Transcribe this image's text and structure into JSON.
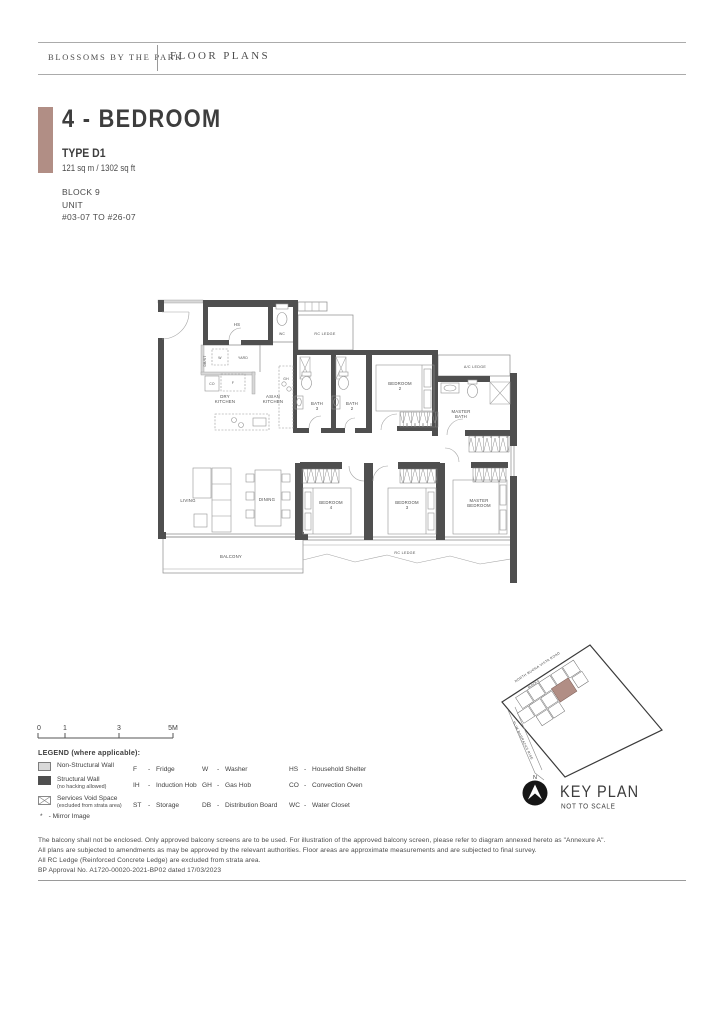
{
  "header": {
    "brand": "BLOSSOMS BY THE PARK",
    "section": "FLOOR PLANS"
  },
  "title_block": {
    "title": "4 - BEDROOM",
    "type": "TYPE D1",
    "area": "121 sq m / 1302 sq ft",
    "block": "BLOCK 9",
    "unit_label": "UNIT",
    "unit_range": "#03-07 TO #26-07"
  },
  "floor_plan": {
    "labels": {
      "hs": "HS",
      "wc": "WC",
      "rc_ledge_top": "RC LEDGE",
      "db_st": "DB/ST",
      "washer": "W",
      "yard": "YARD",
      "co": "CO",
      "fridge": "F",
      "dry_kitchen": [
        "DRY",
        "KITCHEN"
      ],
      "asian_kitchen": [
        "ASIAN",
        "KITCHEN"
      ],
      "gh": "GH",
      "bath3": [
        "BATH",
        "3"
      ],
      "bath2": [
        "BATH",
        "2"
      ],
      "bedroom2": [
        "BEDROOM",
        "2"
      ],
      "ac_ledge": "A/C LEDGE",
      "master_bath": [
        "MASTER",
        "BATH"
      ],
      "living": "LIVING",
      "dining": "DINING",
      "bedroom4": [
        "BEDROOM",
        "4"
      ],
      "bedroom3": [
        "BEDROOM",
        "3"
      ],
      "master_bedroom": [
        "MASTER",
        "BEDROOM"
      ],
      "balcony": "BALCONY",
      "rc_ledge_bottom": "RC LEDGE"
    }
  },
  "scale_bar": {
    "ticks": [
      "0",
      "1",
      "3",
      "5M"
    ]
  },
  "legend": {
    "title": "LEGEND (where applicable):",
    "separator": "-",
    "wall_items": [
      {
        "label": "Non-Structural Wall",
        "sub": ""
      },
      {
        "label": "Structural Wall",
        "sub": "(no hacking allowed)"
      },
      {
        "label": "Services Void Space",
        "sub": "(excluded from strata area)"
      }
    ],
    "mirror_symbol": "*",
    "mirror_text": "- Mirror Image",
    "abbreviations": [
      {
        "code": "F",
        "desc": "Fridge"
      },
      {
        "code": "IH",
        "desc": "Induction Hob"
      },
      {
        "code": "ST",
        "desc": "Storage"
      },
      {
        "code": "W",
        "desc": "Washer"
      },
      {
        "code": "GH",
        "desc": "Gas Hob"
      },
      {
        "code": "DB",
        "desc": "Distribution Board"
      },
      {
        "code": "HS",
        "desc": "Household Shelter"
      },
      {
        "code": "CO",
        "desc": "Convection Oven"
      },
      {
        "code": "WC",
        "desc": "Water Closet"
      }
    ]
  },
  "key_plan": {
    "title": "KEY PLAN",
    "subtitle": "NOT TO SCALE",
    "north": "N",
    "road_top": "NORTH BUONA VISTA ROAD",
    "road_left": "SLIM BARRACKS RISE",
    "block": "BLOCK 9"
  },
  "footnotes": [
    "The balcony shall not be enclosed. Only approved balcony screens are to be used. For illustration of the approved balcony screen, please refer to diagram annexed hereto as \"Annexure A\".",
    "All plans are subjected to amendments as may be approved by the relevant authorities. Floor areas are approximate measurements and are subjected to final survey.",
    "All RC Ledge (Reinforced Concrete Ledge) are excluded from strata area.",
    "BP Approval No. A1720-00020-2021-BP02 dated 17/03/2023"
  ],
  "colors": {
    "accent": "#b18e85",
    "wall_dark": "#4f4f4f",
    "wall_light": "#d8d8d8"
  }
}
